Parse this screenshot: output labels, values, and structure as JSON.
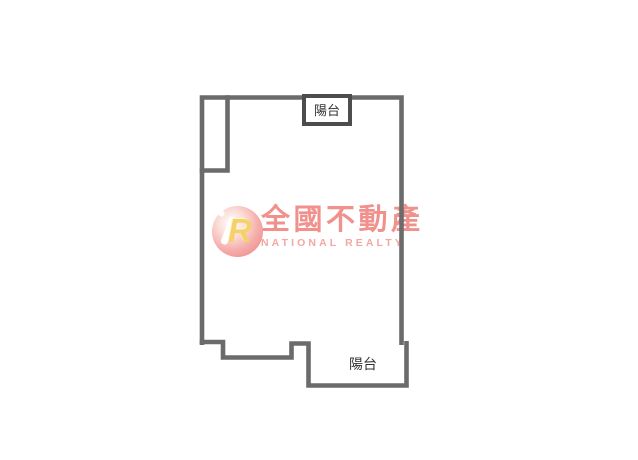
{
  "canvas": {
    "width": 638,
    "height": 460,
    "background": "#ffffff"
  },
  "floor_plan": {
    "wall_color": "#6b6b6b",
    "balcony_box_border_color": "#4d4d4d",
    "label_color": "#323232",
    "top_balcony_label": "陽台",
    "bottom_balcony_label": "陽台"
  },
  "watermark": {
    "logo_letter": "R",
    "logo_letter_color": "#f5d169",
    "brand_chinese": "全國不動產",
    "brand_english": "NATIONAL REALTY",
    "chinese_color": "#f0918d",
    "english_color": "#f3a7a3",
    "circle_outer_color": "#ee8b8b",
    "circle_inner_color": "#fbdcd7"
  }
}
